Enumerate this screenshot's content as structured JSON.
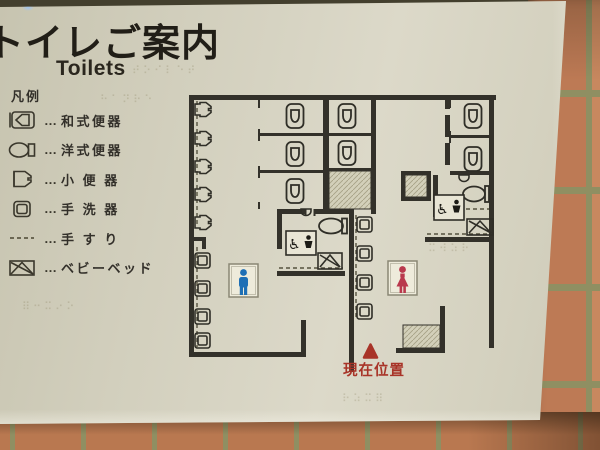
{
  "sign": {
    "title": "トイレご案内",
    "title_en": "Toilets"
  },
  "legend": {
    "heading": "凡例",
    "leader": "…",
    "items": [
      {
        "label": "和式便器"
      },
      {
        "label": "洋式便器"
      },
      {
        "label": "小 便 器"
      },
      {
        "label": "手 洗 器"
      },
      {
        "label": "手 す り"
      },
      {
        "label": "ベビーベッド"
      }
    ]
  },
  "map": {
    "current_location_label": "現在位置",
    "fixtures": {
      "urinals": 5,
      "mens_wash_basins": 4,
      "womens_wash_basins": 4,
      "mens_stall_toilets": 5,
      "womens_stall_toilets": 2,
      "accessible_toilets": 2,
      "baby_beds": 2
    },
    "symbols": {
      "mens": "male-pictogram",
      "womens": "female-pictogram",
      "accessible": "wheelchair-and-baby-pictogram"
    }
  },
  "colors": {
    "male_symbol": "#1e6fb5",
    "female_symbol": "#b9394d",
    "current_location": "#a83428",
    "wall": "#33312a",
    "sign_background": "#d5d2c0",
    "tile": "#bd7a55",
    "grout": "#8f8f62"
  },
  "braille_texture": [
    "⠞⠕⠊⠇⠑⠞",
    "⠓⠁⠝⠗⠑",
    "⠿⠒⠭⠔⠕",
    "⠗⠵⠭⠿",
    "⠭⠺⠵⠗"
  ]
}
